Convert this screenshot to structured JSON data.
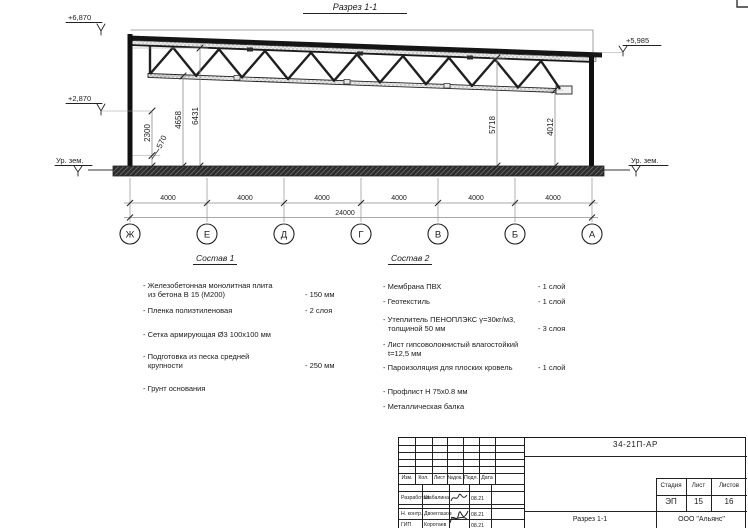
{
  "drawing": {
    "title": "Разрез 1-1",
    "elevations": {
      "top_left": "+6,870",
      "mid_left": "+2,870",
      "ground_left": "Ур. зем.",
      "top_right": "+5,985",
      "ground_right": "Ур. зем."
    },
    "vertical_dims": {
      "v2300": "2300",
      "v570": "570",
      "v4658": "4658",
      "v6431": "6431",
      "v5718": "5718",
      "v4012": "4012"
    },
    "axes": {
      "labels": [
        "Ж",
        "Е",
        "Д",
        "Г",
        "В",
        "Б",
        "А"
      ],
      "span_dims": [
        "4000",
        "4000",
        "4000",
        "4000",
        "4000",
        "4000"
      ],
      "total_dim": "24000"
    }
  },
  "sostav1": {
    "title": "Состав 1",
    "items": [
      {
        "text": "- Железобетонная монолитная плита\nиз бетона В 15 (М200)",
        "value": "- 150 мм"
      },
      {
        "text": "- Пленка полиэтиленовая",
        "value": "- 2 слоя"
      },
      {
        "text": "- Сетка армирующая Ø3 100х100 мм",
        "value": ""
      },
      {
        "text": "- Подготовка из песка средней\nкрупности",
        "value": "- 250 мм"
      },
      {
        "text": "- Грунт основания",
        "value": ""
      }
    ]
  },
  "sostav2": {
    "title": "Состав 2",
    "items": [
      {
        "text": "- Мембрана ПВХ",
        "value": "- 1 слой"
      },
      {
        "text": "- Геотекстиль",
        "value": "- 1 слой"
      },
      {
        "text": "- Утеплитель ПЕНОПЛЭКС γ=30кг/м3,\nтолщиной 50 мм",
        "value": "- 3 слоя"
      },
      {
        "text": "- Лист гипсоволокнистый влагостойкий\nt=12,5 мм",
        "value": ""
      },
      {
        "text": "- Пароизоляция для плоских кровель",
        "value": "- 1 слой"
      },
      {
        "text": "- Профлист Н 75х0.8 мм",
        "value": ""
      },
      {
        "text": "- Металлическая балка",
        "value": ""
      }
    ]
  },
  "titleblock": {
    "doc_number": "34-21П-АР",
    "table_headers": [
      "Изм.",
      "Кол.",
      "Лист",
      "№док.",
      "Подл.",
      "Дата"
    ],
    "rows": [
      {
        "role": "Разработал",
        "name": "Шабалина",
        "date": "08.21"
      },
      {
        "role": "Н. контр.",
        "name": "Двоеглазов",
        "date": "08.21"
      },
      {
        "role": "ГИП",
        "name": "Коротаев",
        "date": "08.21"
      }
    ],
    "stage_label": "Стадия",
    "sheet_label": "Лист",
    "sheets_label": "Листов",
    "stage": "ЭП",
    "sheet": "15",
    "sheets": "16",
    "section_name": "Разрез 1-1",
    "company": "ООО \"Альянс\""
  }
}
